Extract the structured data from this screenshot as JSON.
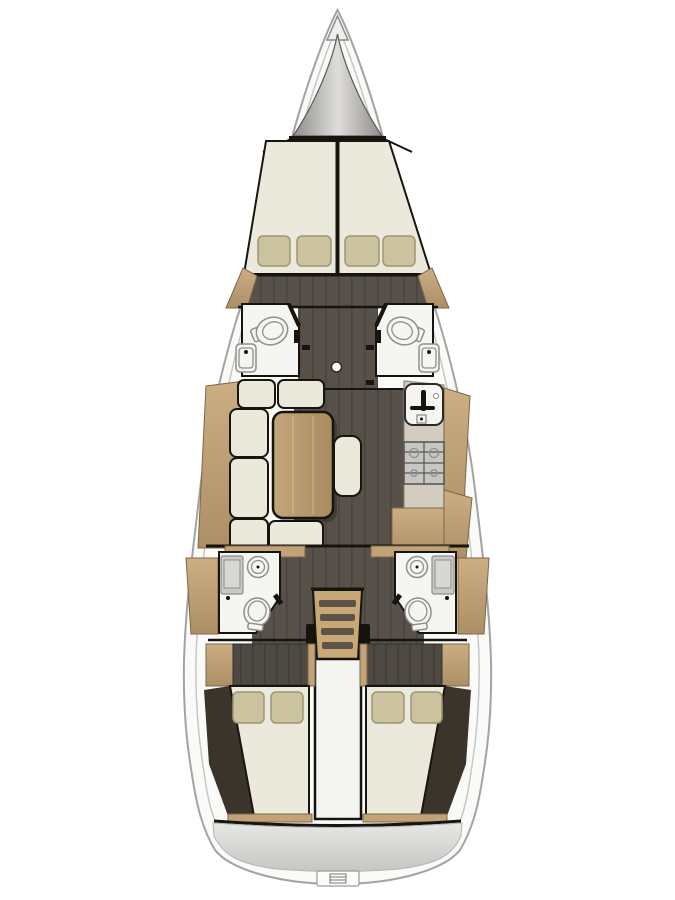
{
  "diagram": {
    "kind": "sailing-yacht-interior-floorplan",
    "orientation": "bow-up",
    "view": "top-down-deck-plan"
  },
  "colors": {
    "pageBg": "#ffffff",
    "hull": "#fafaf8",
    "hullLine": "#a3a3a1",
    "rim": "#c7c7c5",
    "wall": "#16140e",
    "floor": "#57514a",
    "floorLine": "#494440",
    "room": "#f5f5f2",
    "fixtureLine": "#8f8f8d",
    "panelGray": "#c9c9c7",
    "counter": "#d3cdc1",
    "counterLine": "#8e887c",
    "stove": "#c6c6c2",
    "stoveLine": "#5a574f",
    "wood": "#c2a277",
    "woodLight": "#cdae83",
    "woodDark": "#ad8f66",
    "woodLine": "#7c6748",
    "tableLight": "#c5a67b",
    "tableDark": "#a98a61",
    "cushion": "#ebe8dc",
    "cushionLine": "#17150d",
    "pillow": "#cbc39e",
    "pillowLine": "#9e9675",
    "darkWedge": "#3a342b",
    "headboard": "#4e4942",
    "headboardLine": "#413d37",
    "lockerEdge": "#8e8d89",
    "lockerCenter": "#dedddb",
    "engineWhite": "#f4f4f1",
    "ladderWood": "#c9a877",
    "tread": "#5f5345",
    "platformLight": "#e7e7e5",
    "platformDeep": "#c6c6c4"
  },
  "regions": {
    "hull": "hull",
    "anchor_locker": "anchor-locker",
    "v_berth": "forward-cabin-v-berth",
    "forward_head_port": "forward-head-port",
    "forward_head_starboard": "forward-head-starboard",
    "corridor": "forward-corridor",
    "saloon": "saloon",
    "sofa": "l-shaped-sofa",
    "table": "saloon-table",
    "bench": "saloon-bench",
    "galley": "galley",
    "nav_station": "nav-station",
    "aft_head_port": "aft-head-port",
    "aft_head_starboard": "aft-head-starboard",
    "companionway": "companionway-stairs",
    "engine": "engine-compartment",
    "aft_cabin_port": "aft-cabin-port",
    "aft_cabin_starboard": "aft-cabin-starboard",
    "swim_platform": "swim-platform",
    "mast": "mast-post",
    "swim_ladder": "swim-ladder"
  },
  "inventory": {
    "cabins": 3,
    "heads": 4,
    "toilets": 4,
    "showers": 2,
    "sinks": 2,
    "pillows_forward": 4,
    "pillows_aft": 4,
    "stair_treads": 4
  }
}
